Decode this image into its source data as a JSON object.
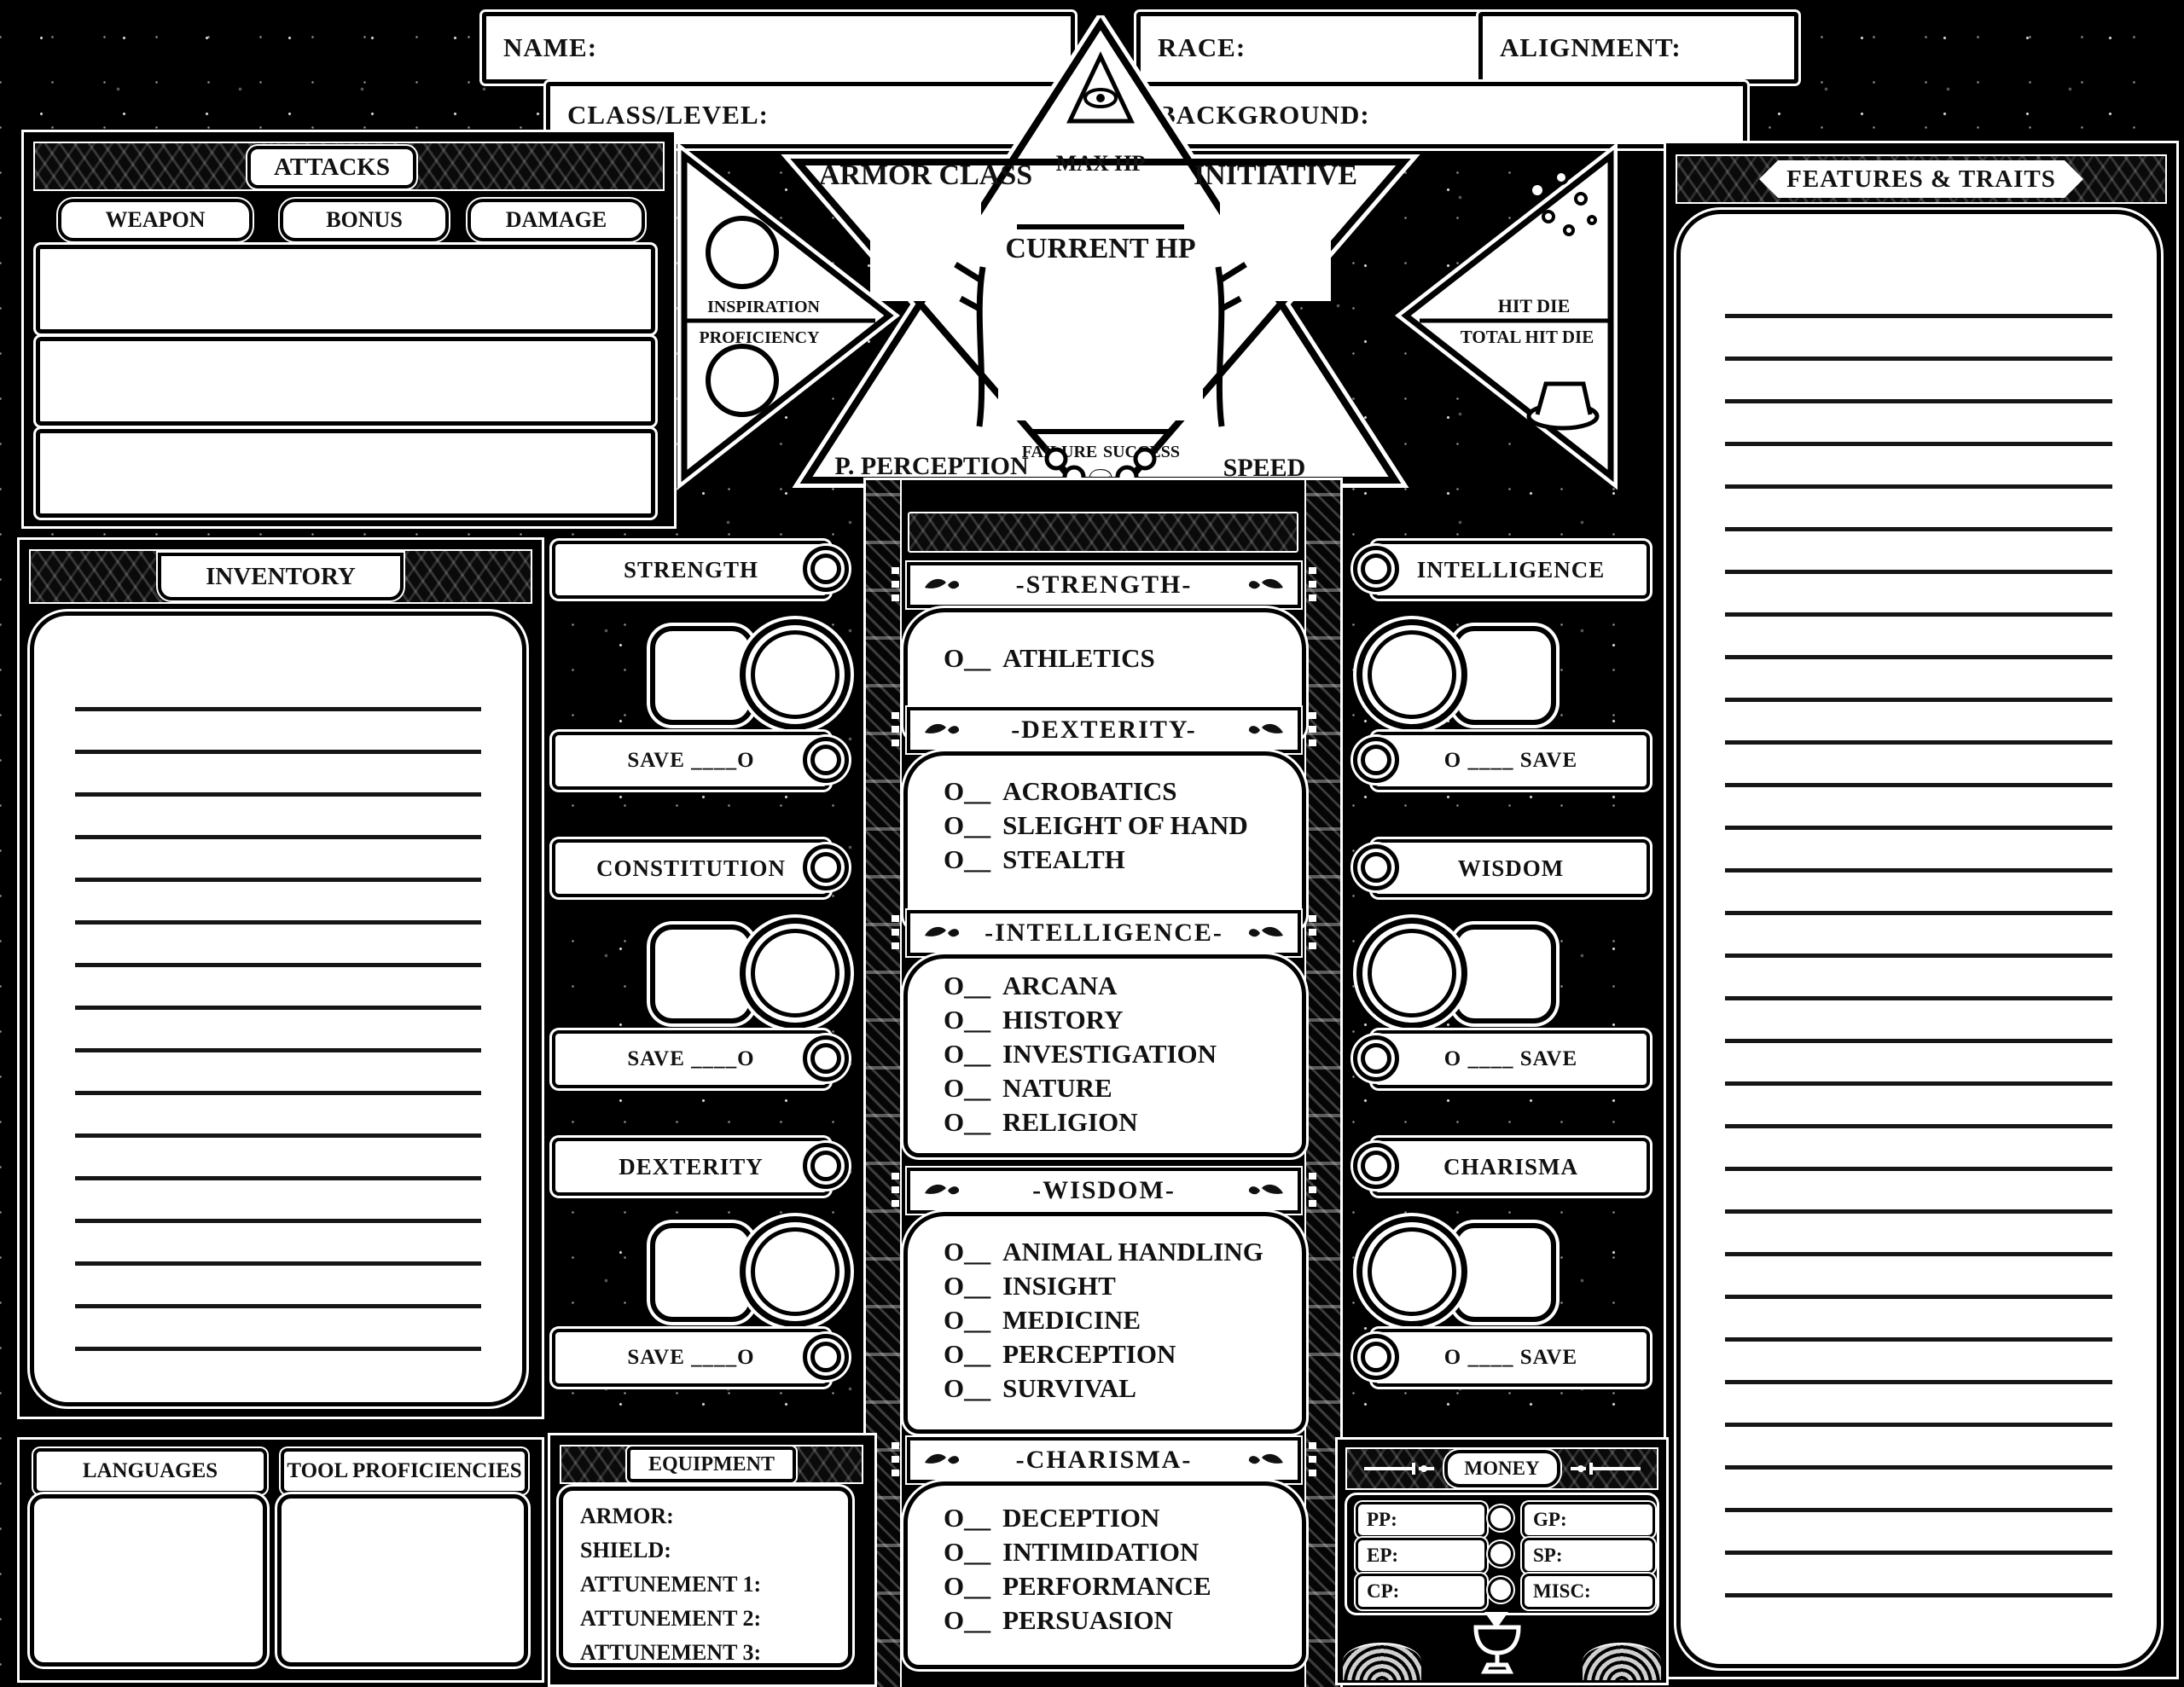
{
  "header": {
    "name_label": "NAME:",
    "class_level_label": "CLASS/LEVEL:",
    "race_label": "RACE:",
    "alignment_label": "ALIGNMENT:",
    "background_label": "BACKGROUND:"
  },
  "attacks": {
    "title": "ATTACKS",
    "columns": [
      "WEAPON",
      "BONUS",
      "DAMAGE"
    ]
  },
  "vitals": {
    "armor_class": "ARMOR CLASS",
    "max_hp": "MAX HP",
    "initiative": "INITIATIVE",
    "current_hp": "CURRENT HP",
    "inspiration": "INSPIRATION",
    "proficiency": "PROFICIENCY",
    "failure": "FAILURE",
    "success": "SUCCESS",
    "p_perception": "P. PERCEPTION",
    "speed": "SPEED",
    "hit_die": "HIT DIE",
    "total_hit_die": "TOTAL HIT DIE"
  },
  "features": {
    "title": "FEATURES & TRAITS"
  },
  "inventory": {
    "title": "INVENTORY"
  },
  "abilities": {
    "left": [
      {
        "name": "STRENGTH",
        "save": "SAVE ____O"
      },
      {
        "name": "CONSTITUTION",
        "save": "SAVE ____O"
      },
      {
        "name": "DEXTERITY",
        "save": "SAVE ____O"
      }
    ],
    "right": [
      {
        "name": "INTELLIGENCE",
        "save": "O ____ SAVE"
      },
      {
        "name": "WISDOM",
        "save": "O ____ SAVE"
      },
      {
        "name": "CHARISMA",
        "save": "O ____ SAVE"
      }
    ]
  },
  "skills": {
    "prefix": "O__",
    "sections": [
      {
        "title": "-STRENGTH-",
        "skills": [
          "ATHLETICS"
        ]
      },
      {
        "title": "-DEXTERITY-",
        "skills": [
          "ACROBATICS",
          "SLEIGHT OF HAND",
          "STEALTH"
        ]
      },
      {
        "title": "-INTELLIGENCE-",
        "skills": [
          "ARCANA",
          "HISTORY",
          "INVESTIGATION",
          "NATURE",
          "RELIGION"
        ]
      },
      {
        "title": "-WISDOM-",
        "skills": [
          "ANIMAL HANDLING",
          "INSIGHT",
          "MEDICINE",
          "PERCEPTION",
          "SURVIVAL"
        ]
      },
      {
        "title": "-CHARISMA-",
        "skills": [
          "DECEPTION",
          "INTIMIDATION",
          "PERFORMANCE",
          "PERSUASION"
        ]
      }
    ]
  },
  "languages": {
    "title": "LANGUAGES"
  },
  "tools": {
    "title": "TOOL PROFICIENCIES"
  },
  "equipment": {
    "title": "EQUIPMENT",
    "fields": [
      "ARMOR:",
      "SHIELD:",
      "ATTUNEMENT 1:",
      "ATTUNEMENT 2:",
      "ATTUNEMENT 3:"
    ]
  },
  "money": {
    "title": "MONEY",
    "left": [
      "PP:",
      "EP:",
      "CP:"
    ],
    "right": [
      "GP:",
      "SP:",
      "MISC:"
    ]
  },
  "colors": {
    "bg": "#000000",
    "paper": "#ffffff",
    "ink": "#111111"
  }
}
